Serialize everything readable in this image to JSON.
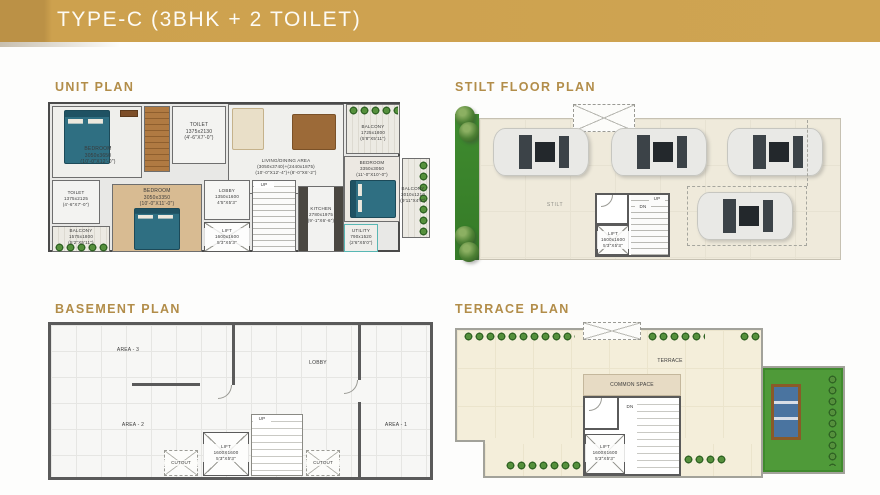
{
  "banner": {
    "title": "TYPE-C (3BHK + 2 TOILET)"
  },
  "colors": {
    "banner_gold": "#CFA452",
    "banner_gold_dark": "#BB9146",
    "heading_gold": "#B28D49",
    "wall_gray": "#5A5A5A",
    "bed_teal": "#2F6F82",
    "lawn_green": "#4F9A39",
    "stilt_floor": "#EFEADB",
    "terrace_floor": "#F4EEDA"
  },
  "sections": {
    "unit_plan": {
      "heading": "UNIT PLAN"
    },
    "stilt_plan": {
      "heading": "STILT FLOOR PLAN"
    },
    "basement_plan": {
      "heading": "BASEMENT PLAN"
    },
    "terrace_plan": {
      "heading": "TERRACE PLAN"
    }
  },
  "unit_plan": {
    "bedroom1": "BEDROOM\n3050x3650\n(10'-0\"X12'-0\")",
    "toilet1": "TOILET\n1375x2130\n(4'-6\"X7'-0\")",
    "living": "LIVING/DINING AREA\n(3050x3740)+(2440x1875)\n(10'-0\"X12'-4\")+(8'-0\"X6'-2\")",
    "balcony_top": "BALCONY\n1725x1800\n(5'8\"X5'11\")",
    "balcony_right": "BALCONY\n3010x1210\n(9'11\"X4'0\")",
    "bedroom3": "BEDROOM\n3350x3050\n(11'-0\"X10'-0\")",
    "toilet2": "TOILET\n1375x2125\n(4'-6\"X7'-0\")",
    "balcony_left": "BALCONY\n1575x1800\n(5'2\"X5'11\")",
    "bedroom2": "BEDROOM\n3050x3350\n(10'-0\"X11'-0\")",
    "lobby": "LOBBY\n1350x1600\n4'5\"X5'3\"",
    "lift": "LIFT\n1600x1600\n5'3\"X5'3\"",
    "kitchen": "KITCHEN\n2780x1975\n(9'-1\"X6'-6\")",
    "utility": "UTILITY\n790x1520\n(2'6\"X5'0\")",
    "up": "UP"
  },
  "stilt_plan": {
    "stilt_label": "STILT",
    "lift": "LIFT\n1600x1600\n5'3\"X5'3\"",
    "up": "UP",
    "dn": "DN"
  },
  "basement_plan": {
    "area3": "AREA - 3",
    "lobby": "LOBBY",
    "area2": "AREA - 2",
    "area1": "AREA - 1",
    "lift": "LIFT\n1600X1600\n5'3\"X5'3\"",
    "up": "UP",
    "cutout_left": "CUTOUT",
    "cutout_right": "CUTOUT"
  },
  "terrace_plan": {
    "terrace_label": "TERRACE",
    "common_space": "COMMON SPACE",
    "lift": "LIFT\n1600X1600\n5'3\"X5'3\"",
    "dn": "DN"
  }
}
